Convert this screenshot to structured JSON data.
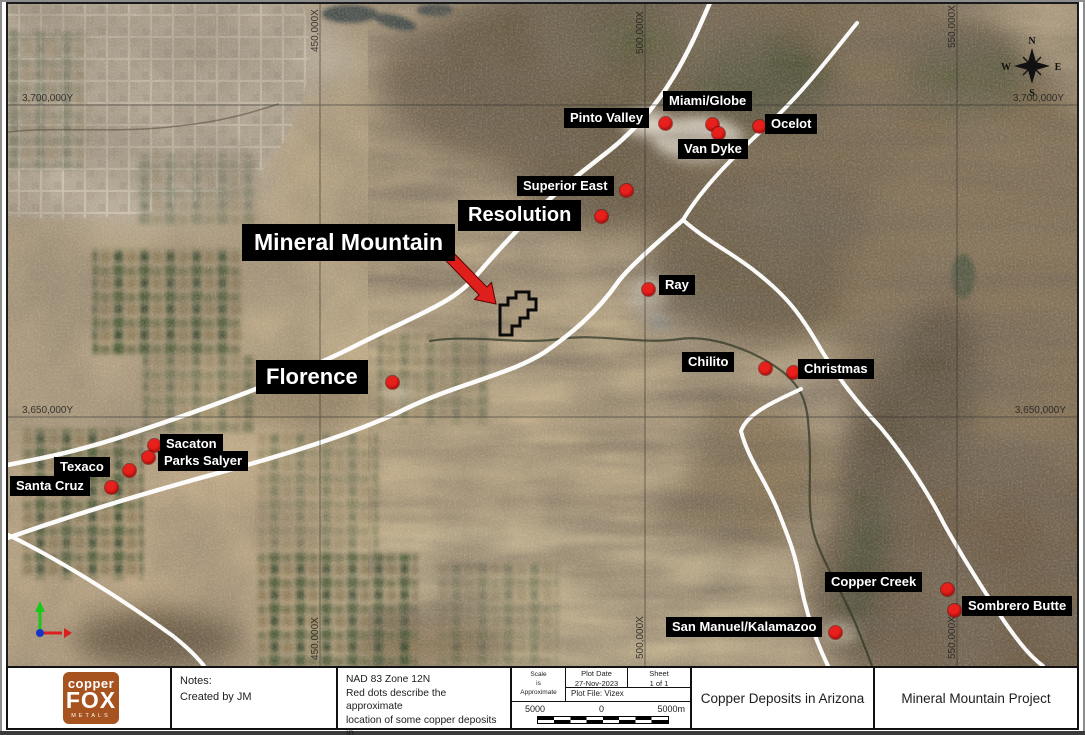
{
  "map": {
    "grid_labels": {
      "y1": "3,700,000Y",
      "y2": "3,650,000Y",
      "x1": "450,000X",
      "x2": "500,000X",
      "x3": "550,000X"
    },
    "compass": {
      "n": "N",
      "e": "E",
      "s": "S",
      "w": "W"
    },
    "marker_color": "#e8201c",
    "label_bg": "#000000",
    "label_fg": "#ffffff",
    "deposits": {
      "pinto_valley": {
        "label": "Pinto Valley"
      },
      "miami_globe": {
        "label": "Miami/Globe"
      },
      "ocelot": {
        "label": "Ocelot"
      },
      "van_dyke": {
        "label": "Van Dyke"
      },
      "superior_east": {
        "label": "Superior East"
      },
      "resolution": {
        "label": "Resolution"
      },
      "mineral_mountain": {
        "label": "Mineral Mountain"
      },
      "ray": {
        "label": "Ray"
      },
      "florence": {
        "label": "Florence"
      },
      "chilito": {
        "label": "Chilito"
      },
      "christmas": {
        "label": "Christmas"
      },
      "sacaton": {
        "label": "Sacaton"
      },
      "parks_salyer": {
        "label": "Parks Salyer"
      },
      "texaco": {
        "label": "Texaco"
      },
      "santa_cruz": {
        "label": "Santa Cruz"
      },
      "copper_creek": {
        "label": "Copper Creek"
      },
      "sombrero_butte": {
        "label": "Sombrero Butte"
      },
      "san_manuel_kalamazoo": {
        "label": "San Manuel/Kalamazoo"
      }
    }
  },
  "footer": {
    "logo": {
      "line1": "copper",
      "line2": "FOX",
      "line3": "METALS",
      "color": "#a7531f"
    },
    "notes": {
      "title": "Notes:",
      "body": "Created by JM"
    },
    "projection": {
      "line1": "NAD 83 Zone 12N",
      "line2": "Red dots describe the approximate",
      "line3": "location of some copper deposits in",
      "line4": "Arizona, USA."
    },
    "scale_block": {
      "scale_l1": "Scale",
      "scale_l2": "is",
      "scale_l3": "Approximate",
      "plot_date_label": "Plot Date",
      "plot_date": "27-Nov-2023",
      "sheet_label": "Sheet",
      "sheet": "1 of 1",
      "plot_file": "Plot File: Vizex",
      "bar_left": "5000",
      "bar_mid": "0",
      "bar_right": "5000m"
    },
    "title": "Copper Deposits in Arizona",
    "project": "Mineral Mountain Project"
  }
}
